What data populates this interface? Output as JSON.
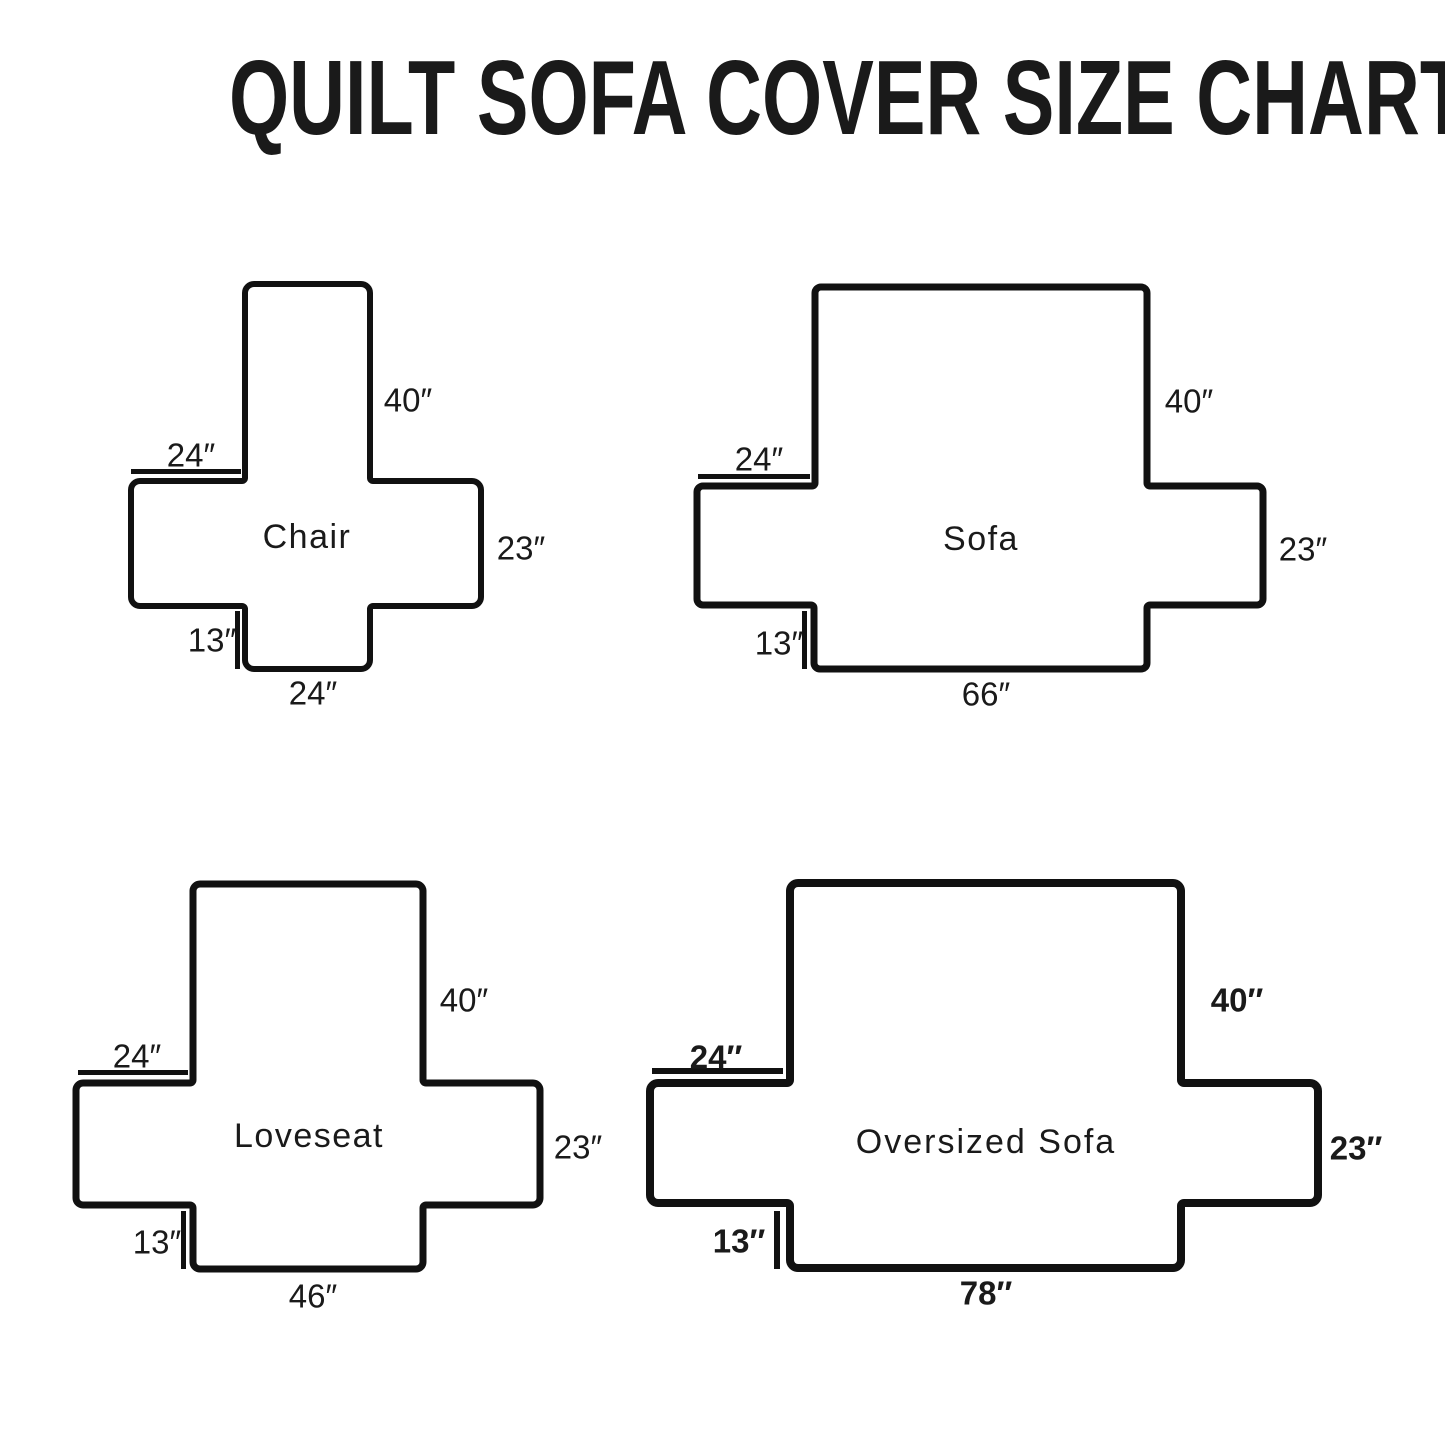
{
  "title": "QUILT SOFA COVER SIZE CHART",
  "colors": {
    "outline": "#111111",
    "background": "#ffffff",
    "text": "#1a1a1a"
  },
  "diagrams": [
    {
      "name": "Chair",
      "dims": {
        "back_height": "40″",
        "arm_length": "24″",
        "side_height": "23″",
        "skirt_height": "13″",
        "bottom_width": "24″"
      },
      "inches": {
        "back_height": 40,
        "arm_length": 24,
        "side_height": 23,
        "skirt_height": 13,
        "bottom_width": 24
      }
    },
    {
      "name": "Sofa",
      "dims": {
        "back_height": "40″",
        "arm_length": "24″",
        "side_height": "23″",
        "skirt_height": "13″",
        "bottom_width": "66″"
      },
      "inches": {
        "back_height": 40,
        "arm_length": 24,
        "side_height": 23,
        "skirt_height": 13,
        "bottom_width": 66
      }
    },
    {
      "name": "Loveseat",
      "dims": {
        "back_height": "40″",
        "arm_length": "24″",
        "side_height": "23″",
        "skirt_height": "13″",
        "bottom_width": "46″"
      },
      "inches": {
        "back_height": 40,
        "arm_length": 24,
        "side_height": 23,
        "skirt_height": 13,
        "bottom_width": 46
      }
    },
    {
      "name": "Oversized Sofa",
      "dims": {
        "back_height": "40″",
        "arm_length": "24″",
        "side_height": "23″",
        "skirt_height": "13″",
        "bottom_width": "78″"
      },
      "inches": {
        "back_height": 40,
        "arm_length": 24,
        "side_height": 23,
        "skirt_height": 13,
        "bottom_width": 78
      }
    }
  ]
}
